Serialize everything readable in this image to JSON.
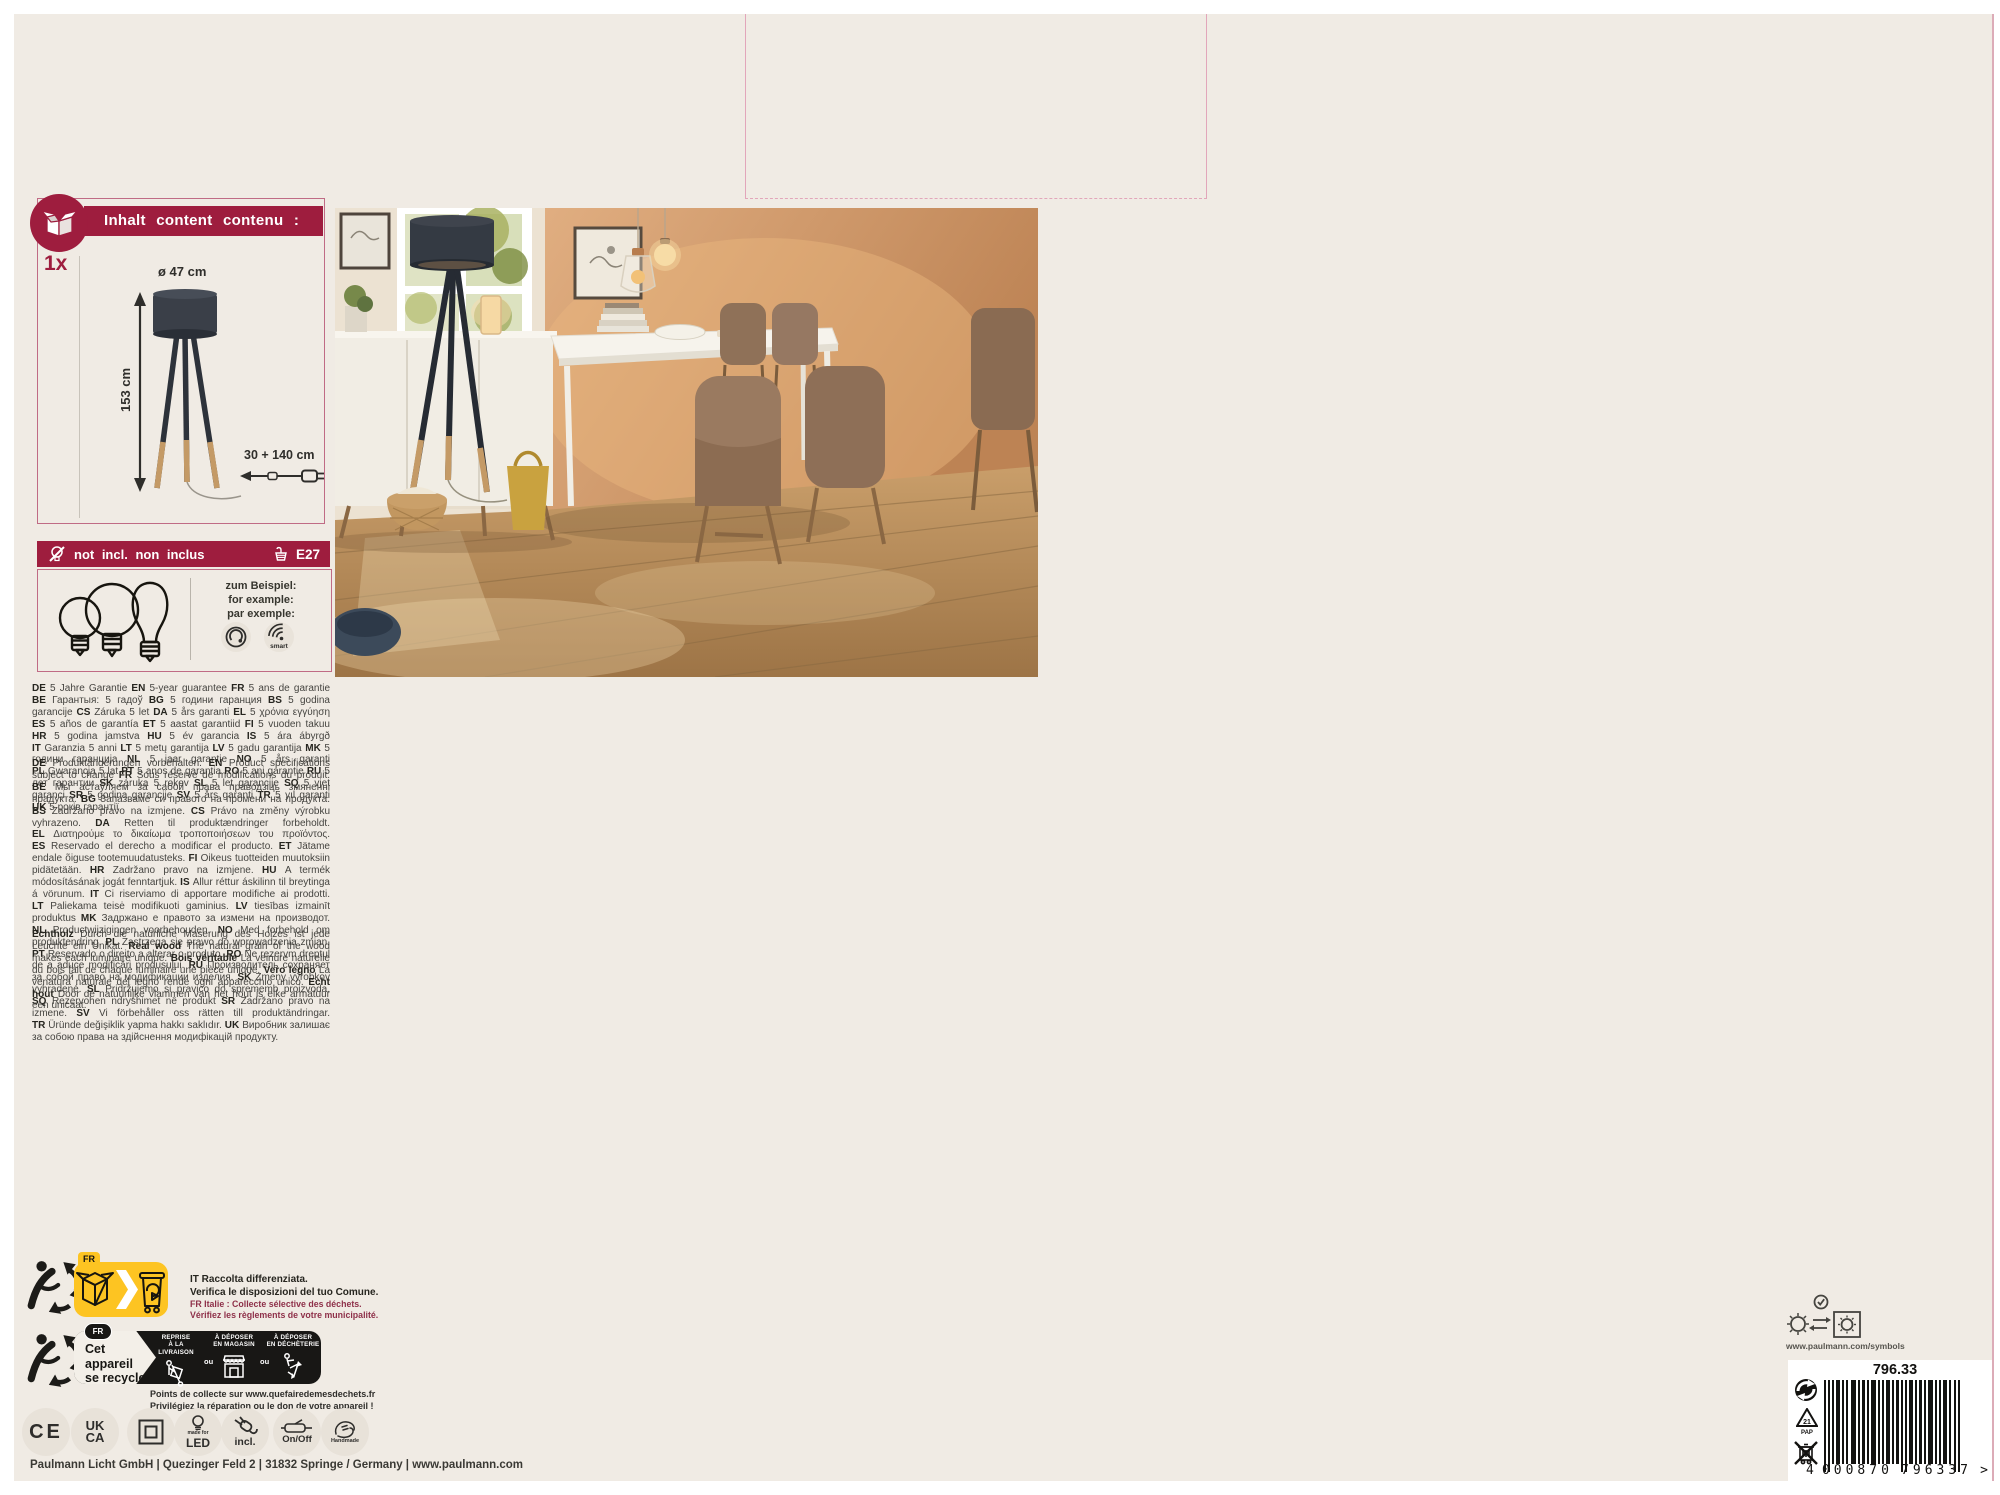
{
  "colors": {
    "brand": "#9e1d3e",
    "panel_bg": "#f0ebe4",
    "accent_yellow": "#fdc422",
    "diecut_pink": "#e2a6ba",
    "text_dark": "#3a3934",
    "lamp_dark": "#343a43",
    "lamp_wood": "#c49a66"
  },
  "contents_panel": {
    "header": "Inhalt content contenu :",
    "quantity": "1x",
    "dim_diameter": "ø 47 cm",
    "dim_height": "153 cm",
    "dim_cable": "30 + 140 cm"
  },
  "not_included": {
    "label": "not incl. non inclus",
    "socket": "E27",
    "example": [
      "zum Beispiel:",
      "for example:",
      "par exemple:"
    ],
    "smart_label": "smart"
  },
  "guarantee_runs": [
    [
      "DE",
      "5 Jahre Garantie"
    ],
    [
      "EN",
      "5-year guarantee"
    ],
    [
      "FR",
      "5 ans de garantie"
    ],
    [
      "BE",
      "Гарантыя: 5 гадоў"
    ],
    [
      "BG",
      "5 години гаранция"
    ],
    [
      "BS",
      "5 godina garancije"
    ],
    [
      "CS",
      "Záruka 5 let"
    ],
    [
      "DA",
      "5 års garanti"
    ],
    [
      "EL",
      "5 χρόνια εγγύηση"
    ],
    [
      "ES",
      "5 años de garantía"
    ],
    [
      "ET",
      "5 aastat garantiid"
    ],
    [
      "FI",
      "5 vuoden takuu"
    ],
    [
      "HR",
      "5 godina jamstva"
    ],
    [
      "HU",
      "5 év garancia"
    ],
    [
      "IS",
      "5 ára ábyrgð"
    ],
    [
      "IT",
      "Garanzia 5 anni"
    ],
    [
      "LT",
      "5 metų garantija"
    ],
    [
      "LV",
      "5 gadu garantija"
    ],
    [
      "MK",
      "5 години гаранција"
    ],
    [
      "NL",
      "5 jaar garantie"
    ],
    [
      "NO",
      "5 års garanti"
    ],
    [
      "PL",
      "Gwarancja 5 lat"
    ],
    [
      "PT",
      "5 anos de garantia"
    ],
    [
      "RO",
      "5 ani garanție"
    ],
    [
      "RU",
      "5 лет гарантии"
    ],
    [
      "SK",
      "záruka 5 rokov"
    ],
    [
      "SL",
      "5 let garancije"
    ],
    [
      "SQ",
      "5 vjet garanci"
    ],
    [
      "SR",
      "5 godina garancije"
    ],
    [
      "SV",
      "5 års garanti"
    ],
    [
      "TR",
      "5 yıl garanti"
    ],
    [
      "UK",
      "5 років гарантії"
    ]
  ],
  "changes_runs": [
    [
      "DE",
      "Produktänderungen vorbehalten."
    ],
    [
      "EN",
      "Product specifications subject to change"
    ],
    [
      "FR",
      "Sous réserve de modifications du produit."
    ],
    [
      "BE",
      "Мы астаўляем за сабой права праводзіць змяненні прадукта."
    ],
    [
      "BG",
      "Запазваме си правото на промени на продукта."
    ],
    [
      "BS",
      "Zadržano pravo na izmjene."
    ],
    [
      "CS",
      "Právo na změny výrobku vyhrazeno."
    ],
    [
      "DA",
      "Retten til produktændringer forbeholdt."
    ],
    [
      "EL",
      "Διατηρούμε το δικαίωμα τροποποιήσεων του προϊόντος."
    ],
    [
      "ES",
      "Reservado el derecho a modificar el producto."
    ],
    [
      "ET",
      "Jätame endale õiguse tootemuudatusteks."
    ],
    [
      "FI",
      "Oikeus tuotteiden muutoksiin pidätetään."
    ],
    [
      "HR",
      "Zadržano pravo na izmjene."
    ],
    [
      "HU",
      "A termék módosításának jogát fenntartjuk."
    ],
    [
      "IS",
      "Allur réttur áskilinn til breytinga á vörunum."
    ],
    [
      "IT",
      "Ci riserviamo di apportare modifiche ai prodotti."
    ],
    [
      "LT",
      "Paliekama teisė modifikuoti gaminius."
    ],
    [
      "LV",
      "tiesības izmainīt produktus"
    ],
    [
      "MK",
      "Задржано е правото за измени на производот."
    ],
    [
      "NL",
      "Productwijzigingen voorbehouden."
    ],
    [
      "NO",
      "Med forbehold om produktendring."
    ],
    [
      "PL",
      "Zastrzega się prawo do wprowadzenia zmian."
    ],
    [
      "PT",
      "Reservado o direito a alterar o produto."
    ],
    [
      "RO",
      "Ne rezervm dreptul de a aduce modificări produsului."
    ],
    [
      "RU",
      "Производитель сохраняет за собой право на модификации изделия."
    ],
    [
      "SK",
      "Zmeny výrobkov vyhradené."
    ],
    [
      "SL",
      "Pridržujemo si pravico do sprememb proizvoda."
    ],
    [
      "SQ",
      "Rezervohen ndryshimet në produkt"
    ],
    [
      "SR",
      "Zadržano pravo na izmene."
    ],
    [
      "SV",
      "Vi förbehåller oss rätten till produktändringar."
    ],
    [
      "TR",
      "Üründe değişiklik yapma hakkı saklıdır."
    ],
    [
      "UK",
      "Виробник залишає за собою права на здійснення модифікацій продукту."
    ]
  ],
  "realwood_runs": [
    [
      "Echtholz",
      "Durch die natürliche Maserung des Holzes ist jede Leuchte ein Unikat."
    ],
    [
      "Real wood",
      "The natural grain of the wood makes each luminaire unique."
    ],
    [
      "Bois véritable",
      "La veinure naturelle du bois fait de chaque luminaire une pièce unique."
    ],
    [
      "Vero legno",
      "La venatura naturale del legno rende ogni apparecchio unico."
    ],
    [
      "Echt hout",
      "Door de natuurlijke vlammen van het hout is elke armatuur een unicaat."
    ]
  ],
  "recycling": {
    "fr_tag": "FR",
    "note_bold_1": "IT Raccolta differenziata.",
    "note_bold_2": "Verifica le disposizioni del tuo Comune.",
    "note_small_1": "FR Italie : Collecte sélective des déchets.",
    "note_small_2": "Vérifiez les règlements de votre municipalité.",
    "device_box": {
      "fr_badge": "FR",
      "title_line1": "Cet appareil",
      "title_line2": "se recycle",
      "col1_l1": "REPRISE",
      "col1_l2": "À LA LIVRAISON",
      "col2_l1": "À DÉPOSER",
      "col2_l2": "EN MAGASIN",
      "col3_l1": "À DÉPOSER",
      "col3_l2": "EN DÉCHÈTERIE",
      "ou": "ou"
    },
    "collect_line1": "Points de collecte sur www.quefairedemesdechets.fr",
    "collect_line2": "Privilégiez la réparation ou le don de votre appareil !"
  },
  "badges": {
    "ce": "CE",
    "ukca_l1": "UK",
    "ukca_l2": "CA",
    "led_small": "made for",
    "led_big": "LED",
    "incl": "incl.",
    "onoff": "On/Off",
    "handmade": "Handmade"
  },
  "footer": "Paulmann Licht GmbH | Quezinger Feld 2 | 31832 Springe / Germany | www.paulmann.com",
  "bottom_right": {
    "symbols_url": "www.paulmann.com/symbols",
    "item_number": "796.33",
    "ean_first": "4",
    "ean_group1": "000870",
    "ean_group2": "796337",
    "ean_suffix": ">",
    "pap_code": "21",
    "pap_label": "PAP"
  },
  "icons": {
    "contents": "open-box-icon",
    "not_included": "bulb-slash-icon",
    "socket": "e27-socket-icon",
    "dimmable": "dimmer-icon",
    "smart": "smart-wifi-icon",
    "triman": "triman-recycling-icon",
    "packaging_sort": "cardboard-to-bin-icon",
    "class2": "class-ii-double-square-icon",
    "led": "made-for-led-icon",
    "plug": "plug-included-icon",
    "switch": "on-off-switch-icon",
    "handmade": "handmade-hands-icon",
    "green_dot": "green-dot-icon",
    "pap": "pap-21-recycling-triangle-icon",
    "weee": "crossed-out-wheelie-bin-icon",
    "symbols": "sun-indoor-outdoor-symbols-icon"
  }
}
